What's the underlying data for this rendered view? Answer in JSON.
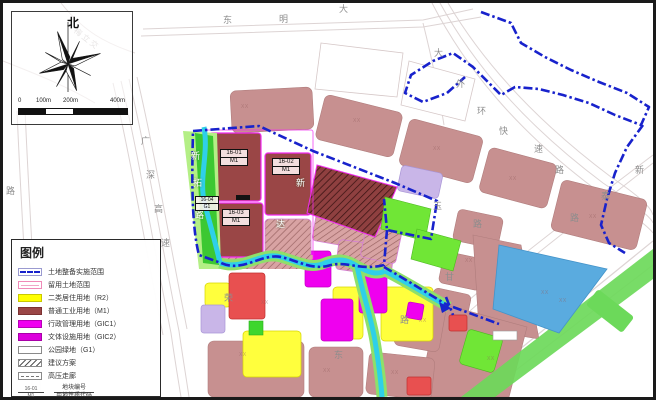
{
  "compass": {
    "north": "北"
  },
  "scale_bar": {
    "ticks": [
      "0",
      "100m",
      "200m",
      "400m"
    ]
  },
  "legend": {
    "title": "图例",
    "items": [
      {
        "id": "boundary",
        "label": "土地整备实施范围"
      },
      {
        "id": "reserved",
        "label": "留用土地范围"
      },
      {
        "id": "r2",
        "label": "二类居住用地（R2）",
        "color": "#ffff00"
      },
      {
        "id": "m1",
        "label": "普通工业用地（M1）",
        "color": "#9a4646"
      },
      {
        "id": "gic1",
        "label": "行政管理用地（GIC1）",
        "color": "#f000f0"
      },
      {
        "id": "gic2",
        "label": "文体设施用地（GIC2）",
        "color": "#dc00dc"
      },
      {
        "id": "g1",
        "label": "公园绿地（G1）"
      },
      {
        "id": "proposal",
        "label": "建议方案"
      },
      {
        "id": "hv",
        "label": "高压走廊"
      }
    ],
    "code_key": {
      "numerator": "地块编号",
      "denominator": "用地性质代码",
      "sample_numerator": "16-01",
      "sample_denominator": "M1"
    }
  },
  "map": {
    "parcels": [
      {
        "code": "16-01",
        "use": "M1"
      },
      {
        "code": "16-02",
        "use": "M1"
      },
      {
        "code": "16-03",
        "use": "M1"
      },
      {
        "code": "16-04",
        "use": "G1"
      }
    ],
    "roads": {
      "dongming_dadao": [
        "东",
        "明",
        "大"
      ],
      "dawaihuan_expwy": [
        "大",
        "外",
        "环",
        "快",
        "速",
        "路"
      ],
      "xintai_road": [
        "新",
        "泰",
        "路"
      ],
      "guangshen_expwy": [
        "广",
        "深",
        "高",
        "速"
      ],
      "xintuo_road": [
        "新",
        "拓",
        "路"
      ],
      "yu_road": [
        "玉",
        "路"
      ],
      "gan_road": [
        "甘"
      ],
      "dong_road": [
        "东"
      ],
      "rong_road": [
        "荣"
      ],
      "xinda_road": [
        "新",
        "达"
      ],
      "lu_left": [
        "路"
      ],
      "lu_mid": [
        "路"
      ],
      "interchange_faint": "梅立交"
    },
    "faint_code": "XX"
  },
  "colors": {
    "boundary_blue": "#1822cc",
    "water_blue": "#5aabdf",
    "river_cyan": "#2fd0e8",
    "park_green": "#3cc832",
    "industrial_red": "#9a4646",
    "admin_magenta": "#f000f0",
    "residential_yellow": "#ffff3d",
    "urban_pink": "#c79090",
    "bright_green": "#70e636",
    "lavender": "#c9b6e8"
  }
}
